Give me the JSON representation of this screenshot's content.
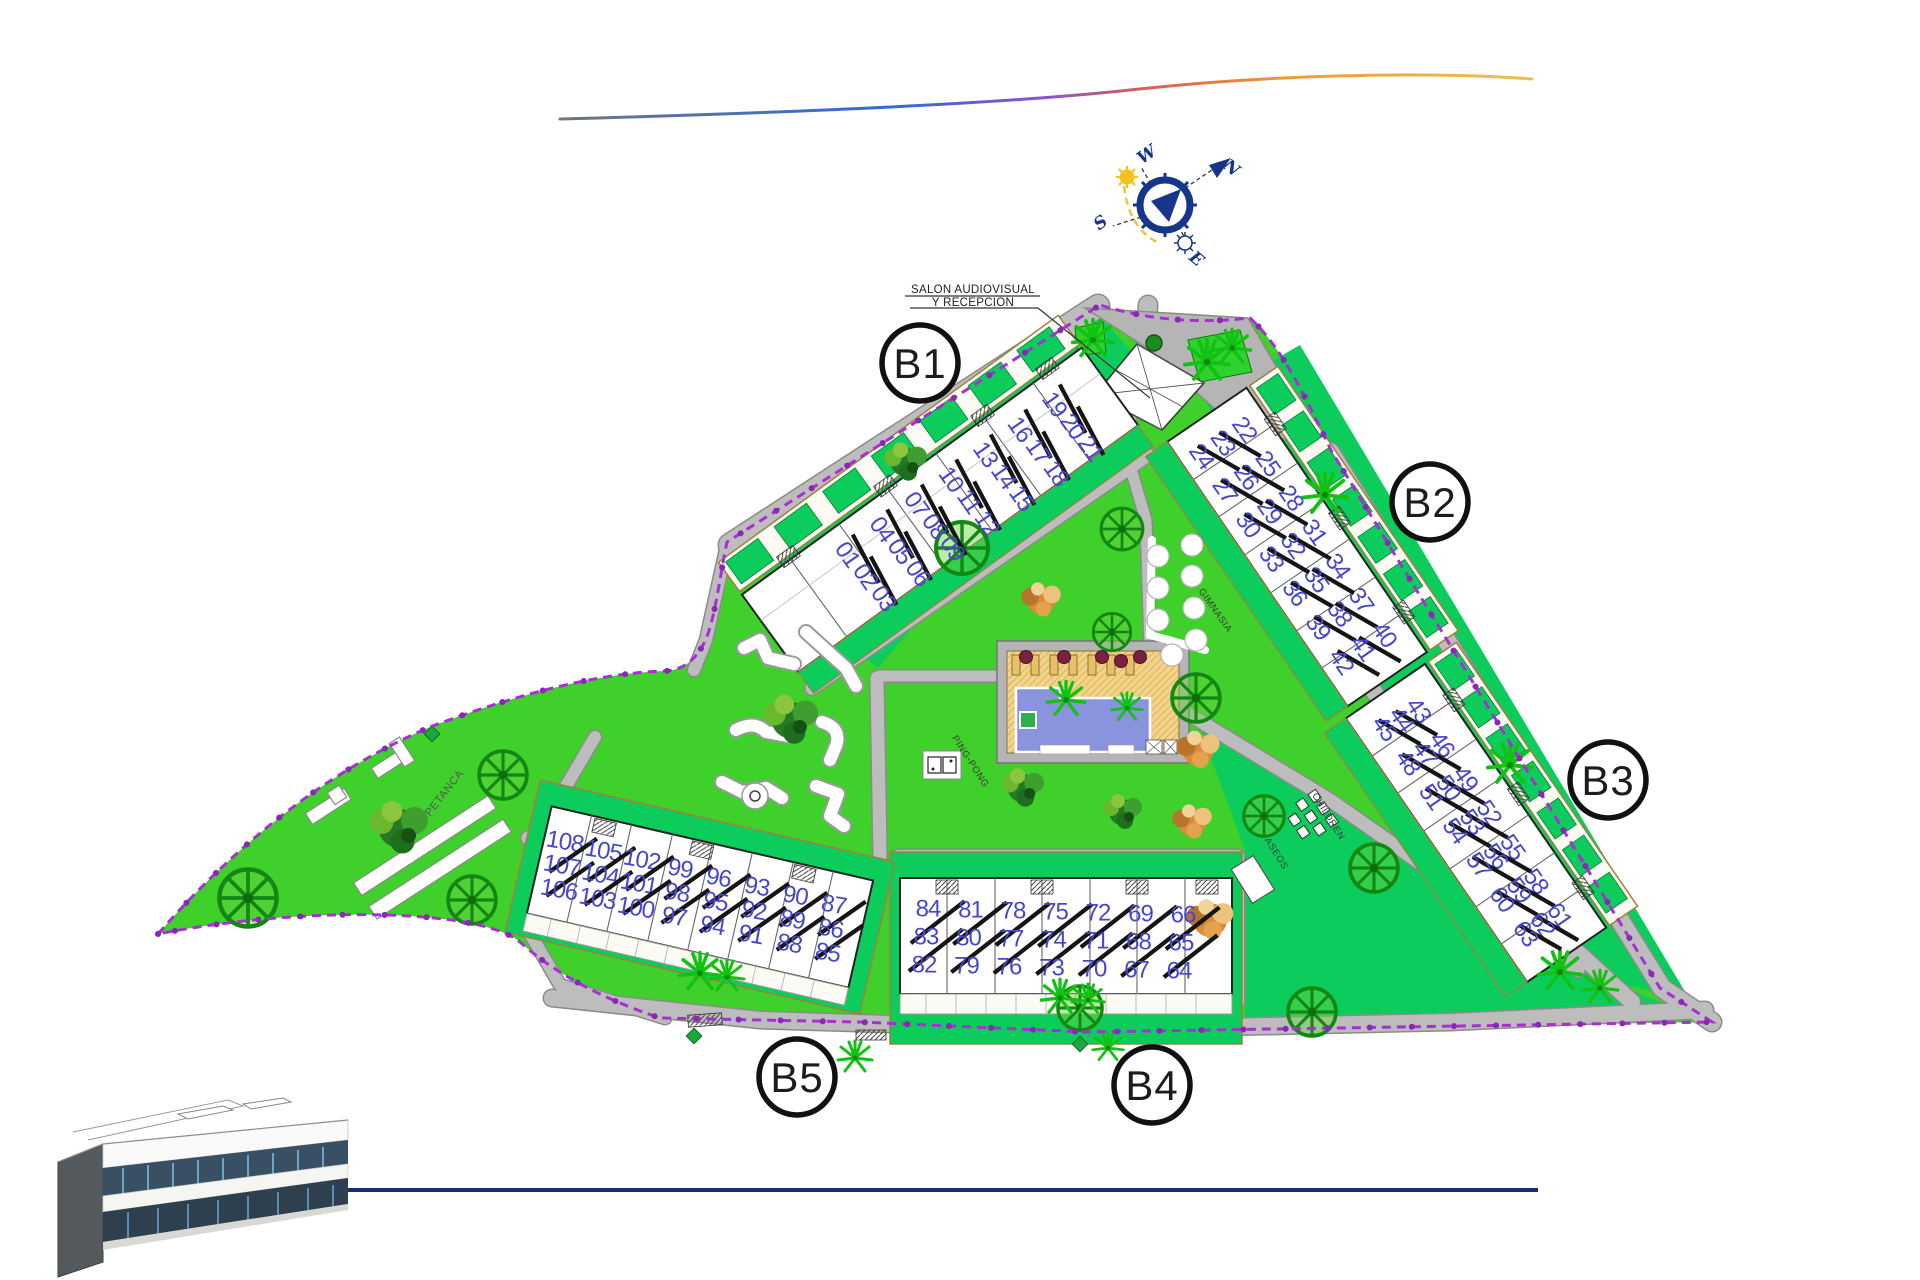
{
  "page": {
    "background": "#ffffff"
  },
  "compass": {
    "n": "N",
    "e": "E",
    "s": "S",
    "w": "W"
  },
  "reception_note": {
    "line1": "SALON AUDIOVISUAL",
    "line2": "Y RECEPCIÓN"
  },
  "blocks": [
    {
      "id": "B1",
      "label": "B1",
      "bays": [
        [
          "01",
          "02",
          "03"
        ],
        [
          "04",
          "05",
          "06"
        ],
        [
          "07",
          "08",
          "09"
        ],
        [
          "10",
          "11",
          "12"
        ],
        [
          "13",
          "14",
          "15"
        ],
        [
          "16",
          "17",
          "18"
        ],
        [
          "19",
          "20",
          "21"
        ]
      ]
    },
    {
      "id": "B2",
      "label": "B2",
      "bays": [
        [
          "22",
          "23",
          "24"
        ],
        [
          "25",
          "26",
          "27"
        ],
        [
          "28",
          "29",
          "30"
        ],
        [
          "31",
          "32",
          "33"
        ],
        [
          "34",
          "35",
          "36"
        ],
        [
          "37",
          "38",
          "39"
        ],
        [
          "40",
          "41",
          "42"
        ]
      ]
    },
    {
      "id": "B3",
      "label": "B3",
      "bays": [
        [
          "43",
          "44",
          "45"
        ],
        [
          "46",
          "47",
          "48"
        ],
        [
          "49",
          "50",
          "51"
        ],
        [
          "52",
          "53",
          "54"
        ],
        [
          "55",
          "56",
          "57"
        ],
        [
          "58",
          "59",
          "60"
        ],
        [
          "61",
          "62",
          "63"
        ]
      ]
    },
    {
      "id": "B4",
      "label": "B4",
      "bays": [
        [
          "84",
          "83",
          "82"
        ],
        [
          "81",
          "80",
          "79"
        ],
        [
          "78",
          "77",
          "76"
        ],
        [
          "75",
          "74",
          "73"
        ],
        [
          "72",
          "71",
          "70"
        ],
        [
          "69",
          "68",
          "67"
        ],
        [
          "66",
          "65",
          "64"
        ]
      ]
    },
    {
      "id": "B5",
      "label": "B5",
      "bays": [
        [
          "108",
          "107",
          "106"
        ],
        [
          "105",
          "104",
          "103"
        ],
        [
          "102",
          "101",
          "100"
        ],
        [
          "99",
          "98",
          "97"
        ],
        [
          "96",
          "95",
          "94"
        ],
        [
          "93",
          "92",
          "91"
        ],
        [
          "90",
          "89",
          "88"
        ],
        [
          "87",
          "86",
          "85"
        ]
      ]
    }
  ],
  "amenities": {
    "petanca": "PETANCA",
    "gimnasia": "GIMNASIA",
    "ping_pong": "PING-PONG",
    "children": "CHILDREN",
    "aseos": "ASEOS"
  },
  "palette": {
    "lawn": "#3fd02b",
    "garden": "#0ccd5c",
    "road": "#bdbdbd",
    "boundary": "#a82fd4",
    "unit_number": "#4747c9",
    "pool_water": "#8a93dd",
    "pool_deck": "#f2d489",
    "parasol": "#7a2140",
    "compass_blue": "#16368c",
    "swoosh": [
      "#70787d",
      "#2f6bd8",
      "#8a55cc",
      "#d95f57",
      "#f09a38",
      "#ecc24f"
    ],
    "bottom_line": "#15316e"
  }
}
